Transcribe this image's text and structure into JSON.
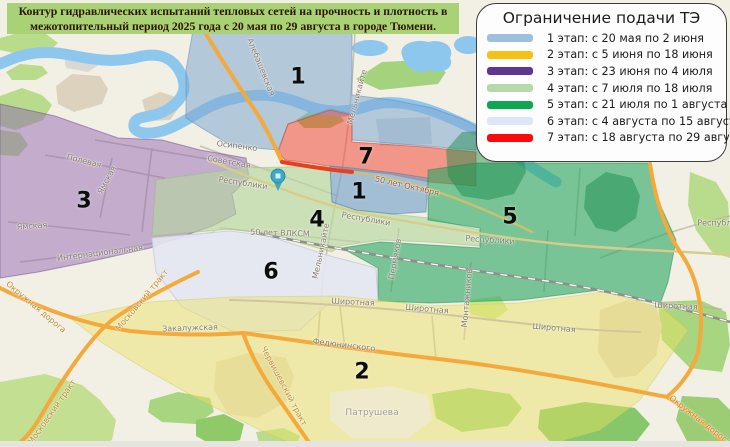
{
  "title": "Контур гидравлических испытаний тепловых сетей на прочность и плотность в межотопительный период 2025 года с 20 мая по 29 августа в городе Тюмени.",
  "legend": {
    "title": "Ограничение подачи ТЭ",
    "items": [
      {
        "label": "1 этап: с 20 мая по 2 июня",
        "color": "#9ec0e0"
      },
      {
        "label": "2 этап: с 5 июня по 18 июня",
        "color": "#f6c114"
      },
      {
        "label": "3 этап: с 23 июня по 4 июля",
        "color": "#5e3591"
      },
      {
        "label": "4 этап: с 7 июля по 18 июля",
        "color": "#b6d9a9"
      },
      {
        "label": "5 этап: с 21 июля по 1 августа",
        "color": "#0ca750"
      },
      {
        "label": "6 этап: с 4 августа по 15 августа",
        "color": "#dde6f4"
      },
      {
        "label": "7 этап: с 18 августа по 29 августа",
        "color": "#fa0a0a"
      }
    ]
  },
  "map": {
    "zone_numbers": [
      "1",
      "7",
      "1",
      "3",
      "4",
      "6",
      "5",
      "2"
    ],
    "street_labels": [
      "Полевая",
      "Ямская",
      "Ямская",
      "Интернациональная",
      "Окружная дорога",
      "Московский тракт",
      "Московский тракт",
      "Закалужская",
      "Федюнинского",
      "Червишевский тракт",
      "Широтная",
      "Широтная",
      "Широтная",
      "Широтная",
      "Монтажников",
      "Пермяков",
      "Мельникайте",
      "Мельникайте",
      "Осипенко",
      "Советская",
      "Республики",
      "Республики",
      "Республики",
      "Республики",
      "50 лет Октября",
      "50 лет ВЛКСМ",
      "Алебашевская",
      "Окружная дорога"
    ],
    "place_labels": [
      "Патрушева"
    ],
    "pin_color": "#3aa9c6"
  }
}
